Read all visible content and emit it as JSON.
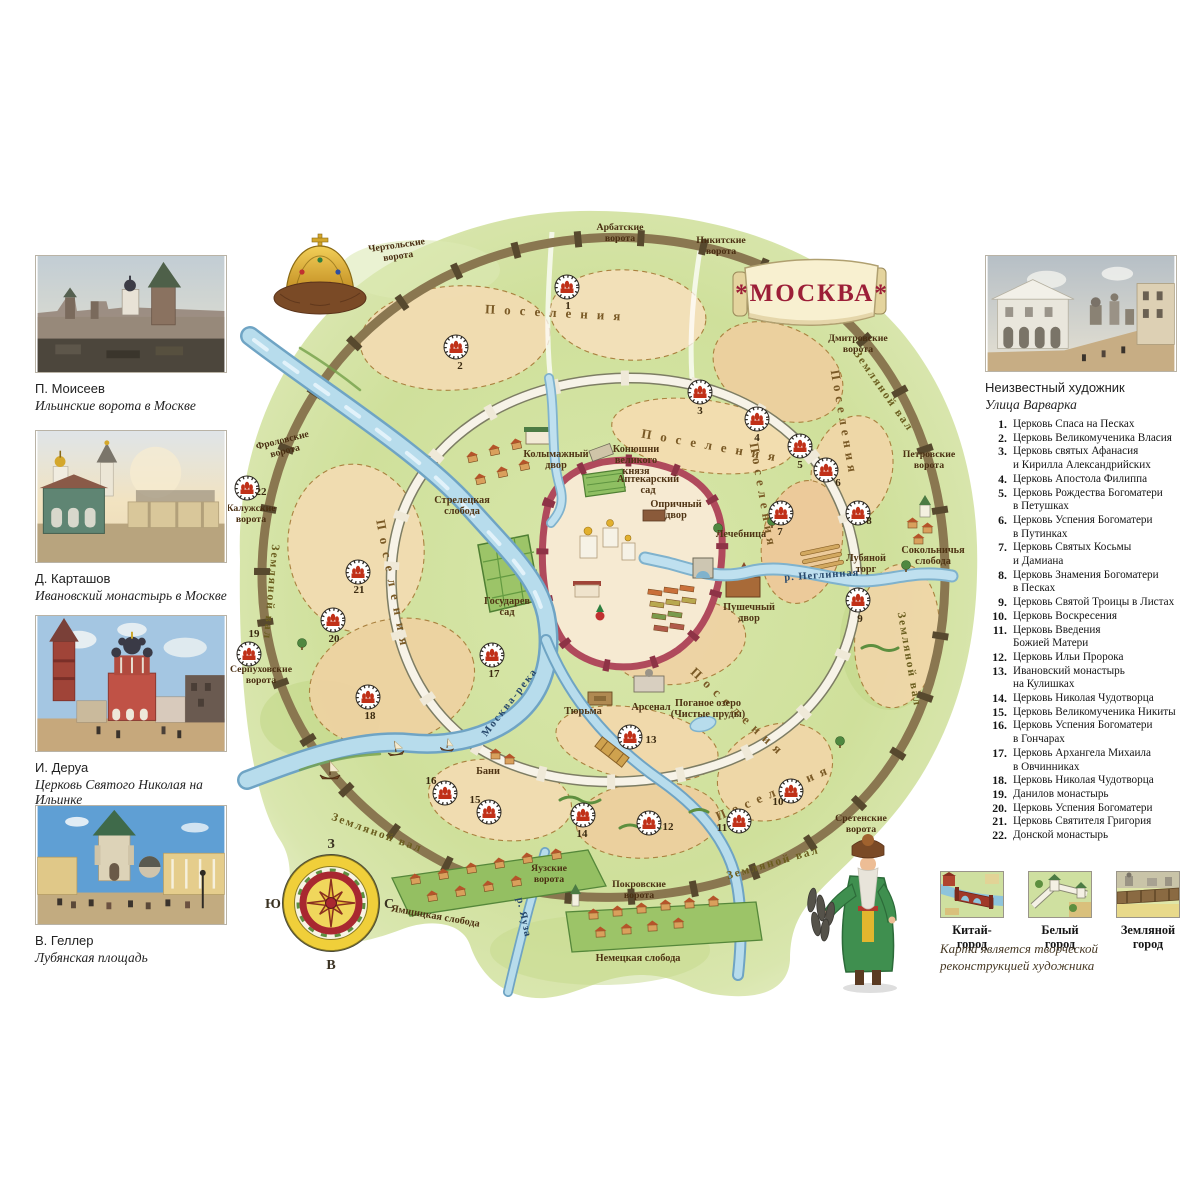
{
  "left_panel": {
    "paintings": [
      {
        "artist": "П. Моисеев",
        "title": "Ильинские ворота в Москве"
      },
      {
        "artist": "Д. Карташов",
        "title": "Ивановский монастырь в Москве"
      },
      {
        "artist": "И. Деруа",
        "title": "Церковь Святого Николая на Ильинке"
      },
      {
        "artist": "В. Геллер",
        "title": "Лубянская площадь"
      }
    ]
  },
  "right_panel": {
    "painting": {
      "artist": "Неизвестный художник",
      "title": "Улица Варварка"
    },
    "legend": [
      {
        "num": "1.",
        "lines": [
          "Церковь Спаса на Песках"
        ]
      },
      {
        "num": "2.",
        "lines": [
          "Церковь Великомученика Власия"
        ]
      },
      {
        "num": "3.",
        "lines": [
          "Церковь святых Афанасия",
          "и Кирилла Александрийских"
        ]
      },
      {
        "num": "4.",
        "lines": [
          "Церковь Апостола Филиппа"
        ]
      },
      {
        "num": "5.",
        "lines": [
          "Церковь Рождества Богоматери",
          "в Петушках"
        ]
      },
      {
        "num": "6.",
        "lines": [
          "Церковь Успения Богоматери",
          "в Путинках"
        ]
      },
      {
        "num": "7.",
        "lines": [
          "Церковь Святых Косьмы",
          "и Дамиана"
        ]
      },
      {
        "num": "8.",
        "lines": [
          "Церковь Знамения Богоматери",
          "в Песках"
        ]
      },
      {
        "num": "9.",
        "lines": [
          "Церковь Святой Троицы в Листах"
        ]
      },
      {
        "num": "10.",
        "lines": [
          "Церковь Воскресения"
        ]
      },
      {
        "num": "11.",
        "lines": [
          "Церковь Введения",
          "Божией Матери"
        ]
      },
      {
        "num": "12.",
        "lines": [
          "Церковь Ильи Пророка"
        ]
      },
      {
        "num": "13.",
        "lines": [
          "Ивановский монастырь",
          "на Кулишках"
        ]
      },
      {
        "num": "14.",
        "lines": [
          "Церковь Николая Чудотворца"
        ]
      },
      {
        "num": "15.",
        "lines": [
          "Церковь Великомученика Никиты"
        ]
      },
      {
        "num": "16.",
        "lines": [
          "Церковь Успения Богоматери",
          "в Гончарах"
        ]
      },
      {
        "num": "17.",
        "lines": [
          "Церковь Архангела Михаила",
          "в Овчинниках"
        ]
      },
      {
        "num": "18.",
        "lines": [
          "Церковь Николая Чудотворца"
        ]
      },
      {
        "num": "19.",
        "lines": [
          "Данилов монастырь"
        ]
      },
      {
        "num": "20.",
        "lines": [
          "Церковь Успения Богоматери"
        ]
      },
      {
        "num": "21.",
        "lines": [
          "Церковь Святителя Григория"
        ]
      },
      {
        "num": "22.",
        "lines": [
          "Донской монастырь"
        ]
      }
    ],
    "wall_legend": [
      {
        "label": "Китай-город"
      },
      {
        "label": "Белый город"
      },
      {
        "label": "Земляной город"
      }
    ],
    "note_lines": [
      "Карта является творческой",
      "реконструкцией художника"
    ]
  },
  "map": {
    "banner": "*МОСКВА*",
    "compass": {
      "top": "З",
      "right": "С",
      "bottom": "В",
      "left": "Ю"
    },
    "gates": [
      {
        "lines": [
          "Чертольские",
          "ворота"
        ],
        "x": 397,
        "y": 248,
        "rot": -8
      },
      {
        "lines": [
          "Арбатские",
          "ворота"
        ],
        "x": 620,
        "y": 230,
        "rot": 0
      },
      {
        "lines": [
          "Никитские",
          "ворота"
        ],
        "x": 721,
        "y": 243,
        "rot": 0
      },
      {
        "lines": [
          "Дмитровские",
          "ворота"
        ],
        "x": 858,
        "y": 341,
        "rot": 0
      },
      {
        "lines": [
          "Петровские",
          "ворота"
        ],
        "x": 929,
        "y": 457,
        "rot": 0
      },
      {
        "lines": [
          "Сретенские",
          "ворота"
        ],
        "x": 861,
        "y": 821,
        "rot": 0
      },
      {
        "lines": [
          "Покровские",
          "ворота"
        ],
        "x": 639,
        "y": 887,
        "rot": 0
      },
      {
        "lines": [
          "Яузские",
          "ворота"
        ],
        "x": 549,
        "y": 871,
        "rot": 0
      },
      {
        "lines": [
          "Серпуховские",
          "ворота"
        ],
        "x": 261,
        "y": 672,
        "rot": 0
      },
      {
        "lines": [
          "Калужские",
          "ворота"
        ],
        "x": 251,
        "y": 511,
        "rot": 0
      },
      {
        "lines": [
          "Фроловские",
          "ворота"
        ],
        "x": 283,
        "y": 443,
        "rot": -14
      }
    ],
    "wall_labels": [
      {
        "text": "Земляной вал",
        "x": 268,
        "y": 592,
        "rot": 95,
        "ls": 2
      },
      {
        "text": "Земляной вал",
        "x": 906,
        "y": 660,
        "rot": 80,
        "ls": 2
      },
      {
        "text": "Земляной вал",
        "x": 881,
        "y": 393,
        "rot": 55,
        "ls": 2
      },
      {
        "text": "Земляной вал",
        "x": 774,
        "y": 866,
        "rot": -16,
        "ls": 2
      },
      {
        "text": "Земляной вал",
        "x": 376,
        "y": 836,
        "rot": 20,
        "ls": 2
      }
    ],
    "settlement_labels": [
      {
        "text": "Поселения",
        "x": 557,
        "y": 317,
        "rot": 3,
        "ls": 9
      },
      {
        "text": "Поселения",
        "x": 712,
        "y": 450,
        "rot": 10,
        "ls": 9
      },
      {
        "text": "Поселения",
        "x": 840,
        "y": 424,
        "rot": 80,
        "ls": 5
      },
      {
        "text": "Поселения",
        "x": 759,
        "y": 497,
        "rot": 80,
        "ls": 5
      },
      {
        "text": "Поселения",
        "x": 389,
        "y": 587,
        "rot": 79,
        "ls": 8
      },
      {
        "text": "Поселения",
        "x": 736,
        "y": 716,
        "rot": 43,
        "ls": 7
      },
      {
        "text": "Поселения",
        "x": 776,
        "y": 796,
        "rot": -23,
        "ls": 7
      }
    ],
    "river_labels": [
      {
        "text": "Москва-река",
        "x": 512,
        "y": 704,
        "rot": -52,
        "ls": 2
      },
      {
        "text": "р. Неглинная",
        "x": 822,
        "y": 578,
        "rot": -4,
        "ls": 1
      },
      {
        "text": "р. Яуза",
        "x": 521,
        "y": 918,
        "rot": 78,
        "ls": 1
      }
    ],
    "place_labels": [
      {
        "lines": [
          "Колымажный",
          "двор"
        ],
        "x": 556,
        "y": 457,
        "rot": 0
      },
      {
        "lines": [
          "Конюшни",
          "великого",
          "князя"
        ],
        "x": 636,
        "y": 452,
        "rot": 0
      },
      {
        "lines": [
          "Аптекарский",
          "сад"
        ],
        "x": 648,
        "y": 482,
        "rot": 0
      },
      {
        "lines": [
          "Опричный",
          "двор"
        ],
        "x": 676,
        "y": 507,
        "rot": 0
      },
      {
        "lines": [
          "Стрелецкая",
          "слобода"
        ],
        "x": 462,
        "y": 503,
        "rot": 0
      },
      {
        "lines": [
          "Государев",
          "сад"
        ],
        "x": 507,
        "y": 604,
        "rot": 0
      },
      {
        "lines": [
          "Лечебница"
        ],
        "x": 741,
        "y": 537,
        "rot": 0
      },
      {
        "lines": [
          "Лубяной",
          "торг"
        ],
        "x": 866,
        "y": 561,
        "rot": 0
      },
      {
        "lines": [
          "Пушечный",
          "двор"
        ],
        "x": 749,
        "y": 610,
        "rot": 0
      },
      {
        "lines": [
          "Тюрьма"
        ],
        "x": 583,
        "y": 714,
        "rot": 0
      },
      {
        "lines": [
          "Арсенал"
        ],
        "x": 651,
        "y": 710,
        "rot": 0
      },
      {
        "lines": [
          "Поганое озеро",
          "(Чистые пруды)"
        ],
        "x": 708,
        "y": 706,
        "rot": 0
      },
      {
        "lines": [
          "Бани"
        ],
        "x": 488,
        "y": 774,
        "rot": 0
      },
      {
        "lines": [
          "Сокольничья",
          "слобода"
        ],
        "x": 933,
        "y": 553,
        "rot": 0
      },
      {
        "lines": [
          "Ямщицкая слобода"
        ],
        "x": 435,
        "y": 919,
        "rot": 10
      },
      {
        "lines": [
          "Немецкая слобода"
        ],
        "x": 638,
        "y": 961,
        "rot": 0
      }
    ],
    "markers": [
      {
        "n": "1",
        "x": 567,
        "y": 287,
        "dx": 1,
        "dy": 22
      },
      {
        "n": "2",
        "x": 456,
        "y": 347,
        "dx": 4,
        "dy": 22
      },
      {
        "n": "3",
        "x": 700,
        "y": 392,
        "dx": 0,
        "dy": 22
      },
      {
        "n": "4",
        "x": 757,
        "y": 419,
        "dx": 0,
        "dy": 22
      },
      {
        "n": "5",
        "x": 800,
        "y": 446,
        "dx": 0,
        "dy": 22
      },
      {
        "n": "6",
        "x": 826,
        "y": 470,
        "dx": 12,
        "dy": 16
      },
      {
        "n": "7",
        "x": 781,
        "y": 513,
        "dx": -1,
        "dy": 22
      },
      {
        "n": "8",
        "x": 858,
        "y": 513,
        "dx": 11,
        "dy": 11
      },
      {
        "n": "9",
        "x": 858,
        "y": 600,
        "dx": 2,
        "dy": 22
      },
      {
        "n": "10",
        "x": 791,
        "y": 791,
        "dx": -13,
        "dy": 14
      },
      {
        "n": "11",
        "x": 739,
        "y": 821,
        "dx": -17,
        "dy": 10
      },
      {
        "n": "12",
        "x": 649,
        "y": 823,
        "dx": 19,
        "dy": 7
      },
      {
        "n": "13",
        "x": 630,
        "y": 737,
        "dx": 21,
        "dy": 6
      },
      {
        "n": "14",
        "x": 583,
        "y": 815,
        "dx": -1,
        "dy": 22
      },
      {
        "n": "15",
        "x": 489,
        "y": 812,
        "dx": -14,
        "dy": -9
      },
      {
        "n": "16",
        "x": 445,
        "y": 793,
        "dx": -14,
        "dy": -9
      },
      {
        "n": "17",
        "x": 492,
        "y": 655,
        "dx": 2,
        "dy": 22
      },
      {
        "n": "18",
        "x": 368,
        "y": 697,
        "dx": 2,
        "dy": 22
      },
      {
        "n": "19",
        "x": 249,
        "y": 654,
        "dx": 5,
        "dy": -17
      },
      {
        "n": "20",
        "x": 333,
        "y": 620,
        "dx": 1,
        "dy": 22
      },
      {
        "n": "21",
        "x": 358,
        "y": 572,
        "dx": 1,
        "dy": 21
      },
      {
        "n": "22",
        "x": 247,
        "y": 488,
        "dx": 14,
        "dy": 7
      }
    ]
  }
}
